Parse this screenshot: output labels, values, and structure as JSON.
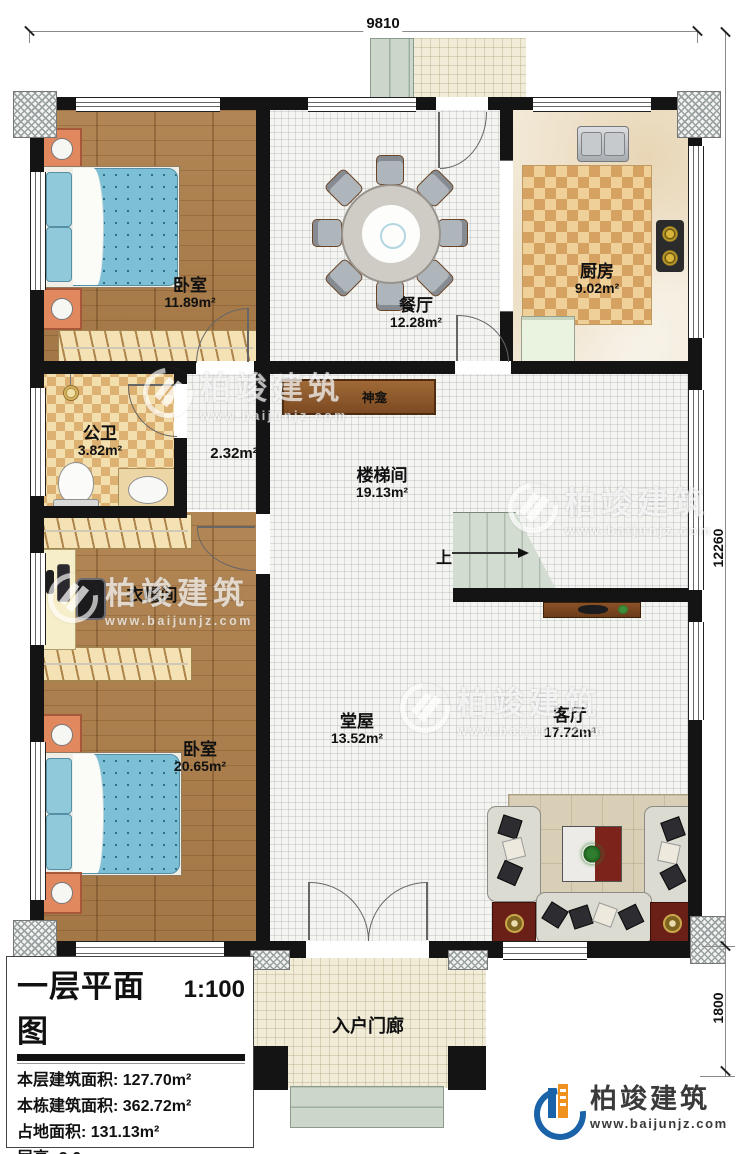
{
  "dimensions": {
    "top_width": "9810",
    "right_height_main": "12260",
    "right_height_porch": "1800"
  },
  "rooms": {
    "bedroom_top": {
      "name": "卧室",
      "area": "11.89m²"
    },
    "dining": {
      "name": "餐厅",
      "area": "12.28m²"
    },
    "kitchen": {
      "name": "厨房",
      "area": "9.02m²"
    },
    "bathroom": {
      "name": "公卫",
      "area": "3.82m²"
    },
    "shrine": {
      "name": "神龛"
    },
    "hallway": {
      "area": "2.32m²"
    },
    "stairwell": {
      "name": "楼梯间",
      "area": "19.13m²",
      "up_label": "上"
    },
    "cloakroom": {
      "name": "衣帽间"
    },
    "bedroom_bottom": {
      "name": "卧室",
      "area": "20.65m²"
    },
    "main_hall": {
      "name": "堂屋",
      "area": "13.52m²"
    },
    "living_room": {
      "name": "客厅",
      "area": "17.72m²"
    },
    "entry_porch": {
      "name": "入户门廊"
    }
  },
  "title_block": {
    "title": "一层平面图",
    "scale": "1:100",
    "lines": [
      "本层建筑面积: 127.70m²",
      "本栋建筑面积: 362.72m²",
      "占地面积: 131.13m²",
      "层高: 3.6m"
    ]
  },
  "branding": {
    "company": "柏竣建筑",
    "website": "www.baijunjz.com"
  },
  "watermark": {
    "company": "柏竣建筑",
    "website": "www.baijunjz.com"
  },
  "colors": {
    "wall": "#141414",
    "wood_floor": "#ae7f4a",
    "bed_blue": "#7dc0d6",
    "nightstand_orange": "#e2885f",
    "kitchen_checker": "#d5a262",
    "stair_green": "#d3dcd1",
    "logo_blue": "#1b63a8",
    "logo_orange": "#f0901e"
  }
}
